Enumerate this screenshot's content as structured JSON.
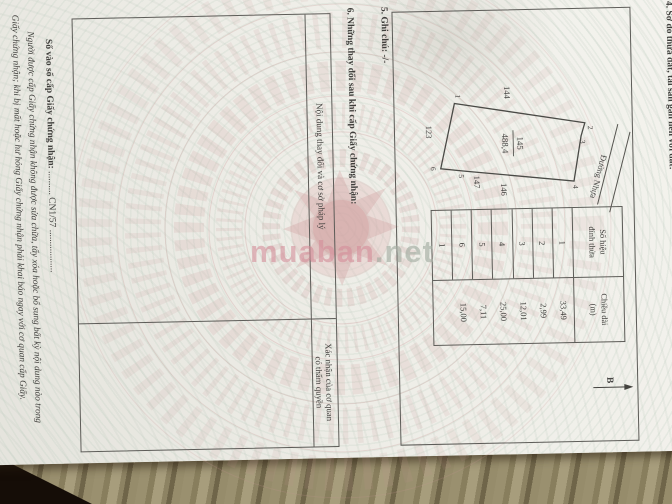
{
  "watermark": {
    "brand": "muaban",
    "suffix": ".net"
  },
  "doc": {
    "section4": {
      "title": "4. Sơ đồ thửa đất, tài sản gắn liền với đất:",
      "north_label": "B",
      "road_label": "Đường Nhựa",
      "parcel": {
        "number": "145",
        "area": "488,4"
      },
      "adjacent": [
        "144",
        "123",
        "146",
        "147"
      ],
      "vertex_labels": [
        "1",
        "2",
        "3",
        "4",
        "5",
        "6"
      ],
      "table": {
        "header_col1_line1": "Số hiệu",
        "header_col1_line2": "đỉnh thửa",
        "header_col2_line1": "Chiều dài",
        "header_col2_line2": "(m)",
        "vertices": [
          "1",
          "2",
          "3",
          "4",
          "5",
          "6",
          "1"
        ],
        "lengths": [
          "33,49",
          "2,99",
          "12,01",
          "25,00",
          "7,11",
          "15,00"
        ]
      }
    },
    "section5": "5. Ghi chú: -/-",
    "section6": {
      "title": "6. Những thay đổi sau khi cấp Giấy chứng nhận:",
      "col1_header": "Nội dung thay đổi và cơ sở pháp lý",
      "col2_header_line1": "Xác nhận của cơ quan",
      "col2_header_line2": "có thẩm quyền"
    },
    "footer": {
      "serial_label": "Số vào sổ cấp Giấy chứng nhận:",
      "serial_dots": "..........",
      "serial_value": "CN1/57",
      "trailing_dots": "..................",
      "note_line1": "Người được cấp Giấy chứng nhận không được sửa chữa, tẩy xóa hoặc bổ sung bất kỳ nội dung nào trong",
      "note_line2": "Giấy chứng nhận; khi bị mất hoặc hư hỏng Giấy chứng nhận phải khai báo ngay với cơ quan cấp Giấy."
    }
  }
}
